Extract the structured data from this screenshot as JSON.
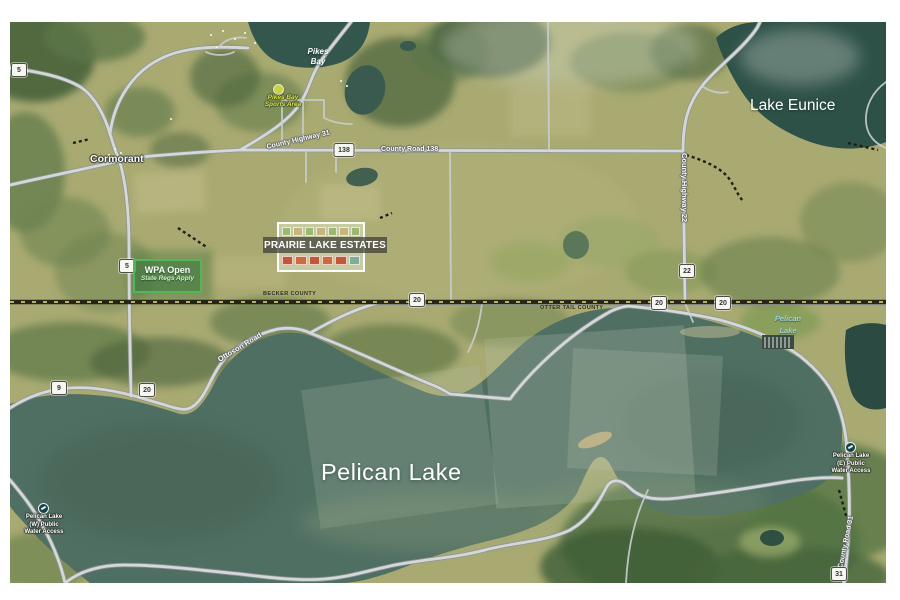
{
  "labels": {
    "town_cormorant": "Cormorant",
    "pikes_bay_line1": "Pikes",
    "pikes_bay_line2": "Bay",
    "lake_eunice": "Lake Eunice",
    "pelican_lake_main": "Pelican Lake",
    "pelican_lake_small_line1": "Pelican",
    "pelican_lake_small_line2": "Lake"
  },
  "road_labels": {
    "county_highway_31": "County Highway 31",
    "county_road_138": "County Road 138",
    "county_highway_22": "County Highway 22",
    "county_road_31": "County Road 31",
    "ottoson_road": "Ottoson Road"
  },
  "county_line": {
    "north": "BECKER COUNTY",
    "south": "OTTER TAIL COUNTY"
  },
  "shields": [
    "5",
    "5",
    "138",
    "22",
    "9",
    "20",
    "20",
    "20",
    "20",
    "31"
  ],
  "estates": {
    "name": "PRAIRIE LAKE ESTATES"
  },
  "wpa_sign": {
    "title": "WPA Open",
    "subtitle": "State Regs Apply"
  },
  "poi": {
    "sports_area": {
      "line1": "Pikes Bay",
      "line2": "Sports Area"
    },
    "west_access": {
      "line1": "Pelican Lake",
      "line2": "(W) Public",
      "line3": "Water Access"
    },
    "east_access": {
      "line1": "Pelican Lake",
      "line2": "(E) Public",
      "line3": "Water Access"
    }
  },
  "colors": {
    "water_pelican": "#4f6f63",
    "water_dark": "#2d5047",
    "land_base": "#a9aa72",
    "forest": "#5c7747",
    "road_fill": "#d4d8d9",
    "wpa_border": "#52b65a",
    "estates_border": "#ffffff",
    "marker_yellow": "#c6d24b",
    "label_cyan": "#9fd4df"
  }
}
